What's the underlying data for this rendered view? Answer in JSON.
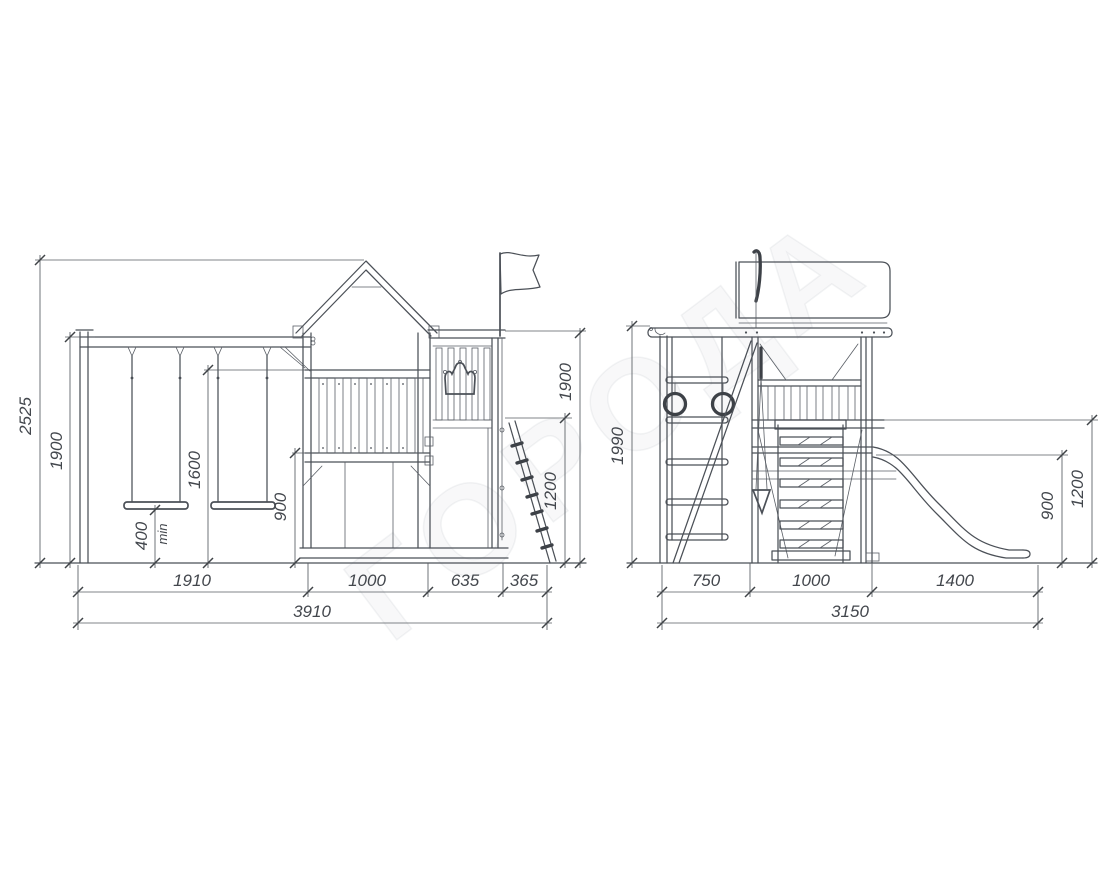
{
  "watermark": "ГОРОДА",
  "front": {
    "heights": {
      "total": "2525",
      "swing_beam": "1900",
      "handrail": "1600",
      "seat": "400",
      "seat_note": "min",
      "platform": "900",
      "panel": "1900",
      "ramp": "1200"
    },
    "widths": {
      "swings": "1910",
      "tower": "1000",
      "panel": "635",
      "ramp": "365",
      "total": "3910"
    }
  },
  "side": {
    "heights": {
      "total": "1990",
      "slide_start": "900",
      "guard": "1200"
    },
    "widths": {
      "ladder": "750",
      "tower": "1000",
      "slide": "1400",
      "total": "3150"
    }
  },
  "colors": {
    "ink": "#4b5057",
    "dim_text": "#43474d",
    "background": "#ffffff"
  }
}
